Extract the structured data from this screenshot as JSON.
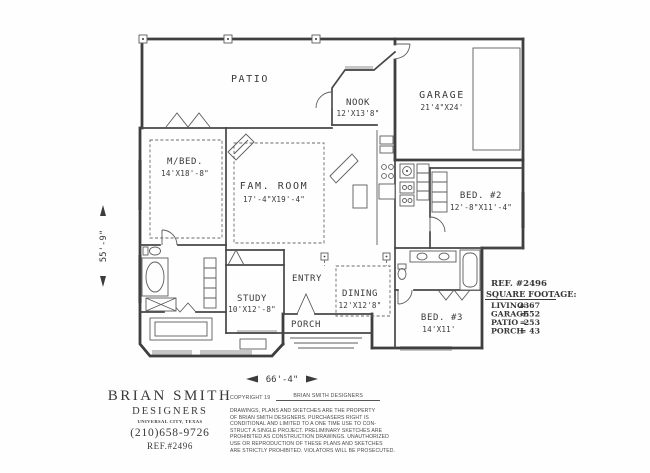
{
  "canvas": {
    "paper_color": "#fefefe",
    "ink_color": "#3c3c3c",
    "window_color": "#c6c6c6"
  },
  "plan": {
    "rooms": [
      {
        "name": "patio",
        "label": "PATIO",
        "dims": ""
      },
      {
        "name": "nook",
        "label": "NOOK",
        "dims": "12'X13'8\""
      },
      {
        "name": "garage",
        "label": "GARAGE",
        "dims": "21'4\"X24'"
      },
      {
        "name": "master-bedroom",
        "label": "M/BED.",
        "dims": "14'X18'-8\""
      },
      {
        "name": "family-room",
        "label": "FAM. ROOM",
        "dims": "17'-4\"X19'-4\""
      },
      {
        "name": "bedroom-2",
        "label": "BED. #2",
        "dims": "12'-8\"X11'-4\""
      },
      {
        "name": "entry",
        "label": "ENTRY",
        "dims": ""
      },
      {
        "name": "study",
        "label": "STUDY",
        "dims": "10'X12'-8\""
      },
      {
        "name": "dining",
        "label": "DINING",
        "dims": "12'X12'8\""
      },
      {
        "name": "porch",
        "label": "PORCH",
        "dims": ""
      },
      {
        "name": "bedroom-3",
        "label": "BED. #3",
        "dims": "14'X11'"
      }
    ],
    "overall_width": "66'-4\"",
    "overall_depth": "55'-9\"",
    "ref": "REF.  #2496",
    "square_footage": {
      "title": "SQUARE FOOTAGE:",
      "equals": "=",
      "rows": [
        {
          "label": "LIVING",
          "value": "2367"
        },
        {
          "label": "GARAGE",
          "value": "552"
        },
        {
          "label": "PATIO",
          "value": "253"
        },
        {
          "label": "PORCH",
          "value": "43"
        }
      ]
    }
  },
  "title_block": {
    "name": "BRIAN SMITH",
    "subtitle": "DESIGNERS",
    "location": "UNIVERSAL CITY, TEXAS",
    "phone": "(210)658-9726",
    "ref": "REF.#2496"
  },
  "copyright_block": {
    "header_left": "COPYRIGHT 19",
    "header_right": "BRIAN SMITH DESIGNERS",
    "lines": [
      "DRAWINGS, PLANS AND SKETCHES ARE THE PROPERTY",
      "OF BRIAN SMITH DESIGNERS.  PURCHASERS RIGHT IS",
      "CONDITIONAL AND LIMITED TO A ONE TIME USE TO CON-",
      "STRUCT A SINGLE PROJECT.  PRELIMINARY SKETCHES ARE",
      "PROHIBITED AS CONSTRUCTION DRAWINGS.  UNAUTHORIZED",
      "USE OR REPRODUCTION OF THESE PLANS AND SKETCHES",
      "ARE STRICTLY PROHIBITED.  VIOLATORS WILL BE PROSECUTED."
    ]
  }
}
